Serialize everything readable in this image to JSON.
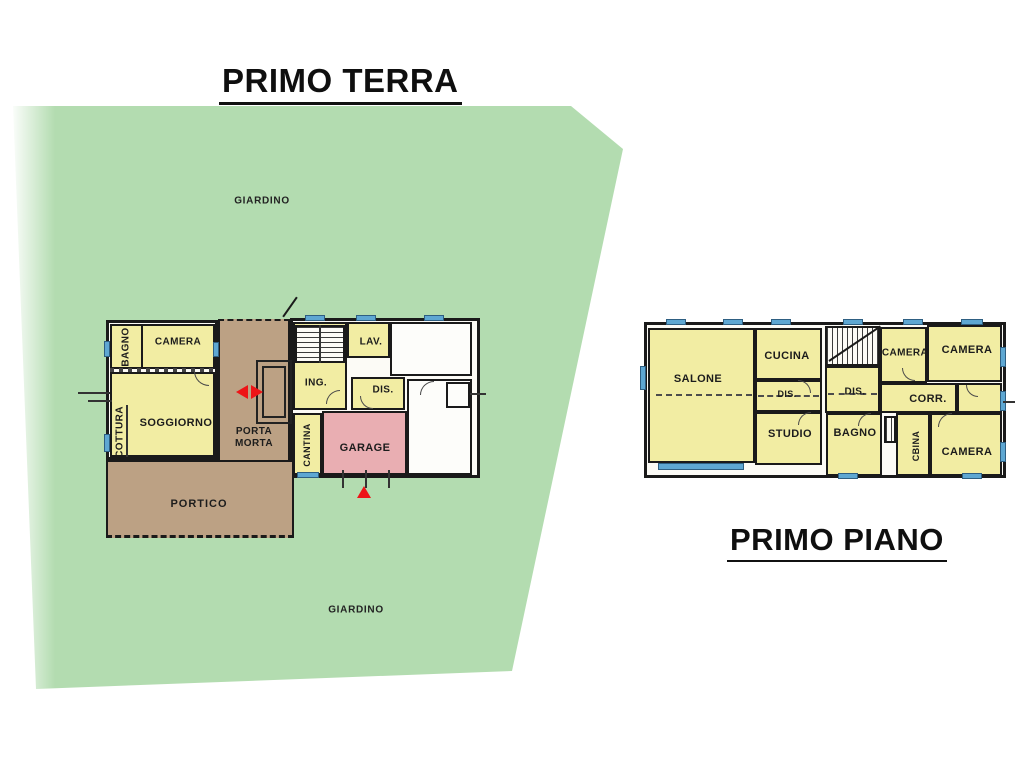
{
  "titles": {
    "ground": "PRIMO TERRA",
    "first": "PRIMO PIANO"
  },
  "garden": {
    "label_top": "GIARDINO",
    "label_bottom": "GIARDINO"
  },
  "colors": {
    "garden_green": "#b3dcb0",
    "room_yellow": "#f2eda3",
    "covered_brown": "#bca184",
    "garage_pink": "#e9aeb2",
    "window_blue": "#5ea7d2",
    "wall_black": "#1a1a1a",
    "arrow_red": "#ee1417"
  },
  "ground_floor": {
    "rooms": {
      "bagno": "BAGNO",
      "camera": "CAMERA",
      "soggiorno": "SOGGIORNO",
      "cottura": "COTTURA",
      "porta_morta": "PORTA MORTA",
      "ing": "ING.",
      "lav": "LAV.",
      "dis": "DIS.",
      "cantina": "CANTINA",
      "garage": "GARAGE",
      "portico": "PORTICO"
    }
  },
  "first_floor": {
    "rooms": {
      "salone": "SALONE",
      "cucina": "CUCINA",
      "dis_left": "DIS.",
      "studio": "STUDIO",
      "dis_right": "DIS.",
      "camera_top_mid": "CAMERA",
      "camera_top_right": "CAMERA",
      "corr": "CORR.",
      "bagno": "BAGNO",
      "cbina": "CBINA",
      "camera_bottom": "CAMERA"
    }
  }
}
